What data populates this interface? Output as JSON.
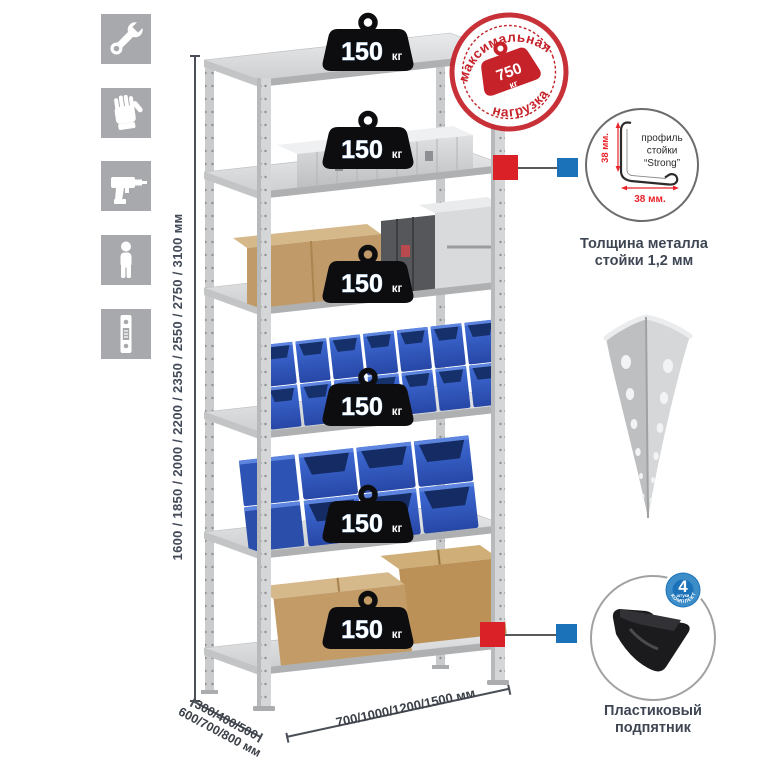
{
  "colors": {
    "accent_red": "#c5222a",
    "marker_red": "#da2128",
    "marker_blue": "#1b72b8",
    "bin_blue": "#2d54b4",
    "metal_gray": "#d2d4d6",
    "icon_gray": "#a7a9ac",
    "cardboard": "#c29b67",
    "text_dark": "#3e4653",
    "dim_red": "#e8232a"
  },
  "left_icons": [
    {
      "name": "wrench-icon"
    },
    {
      "name": "gloves-icon"
    },
    {
      "name": "drill-icon"
    },
    {
      "name": "person-icon"
    },
    {
      "name": "rack-post-icon"
    }
  ],
  "height_dim": {
    "label": "1600 / 1850 / 2000 / 2200 / 2350 / 2550 / 2750 / 3100 мм"
  },
  "depth_dim": {
    "line1": "300/400/500",
    "line2": "600/700/800 мм"
  },
  "width_dim": {
    "label": "700/1000/1200/1500 мм"
  },
  "weights": {
    "items": [
      {
        "value": "150",
        "unit": "кг"
      },
      {
        "value": "150",
        "unit": "кг"
      },
      {
        "value": "150",
        "unit": "кг"
      },
      {
        "value": "150",
        "unit": "кг"
      },
      {
        "value": "150",
        "unit": "кг"
      },
      {
        "value": "150",
        "unit": "кг"
      }
    ]
  },
  "stamp": {
    "arc_top": "максимальная",
    "arc_bottom": "нагрузка",
    "value": "750",
    "unit": "кг"
  },
  "profile": {
    "word1": "профиль",
    "word2": "стойки",
    "word3": "“Strong”",
    "dim_v": "38 мм.",
    "dim_h": "38 мм.",
    "caption1": "Толщина металла",
    "caption2": "стойки 1,2 мм"
  },
  "foot": {
    "badge_value": "4",
    "badge_small": "штуки",
    "badge_arc": "в комплекте",
    "caption1": "Пластиковый",
    "caption2": "подпятник"
  }
}
